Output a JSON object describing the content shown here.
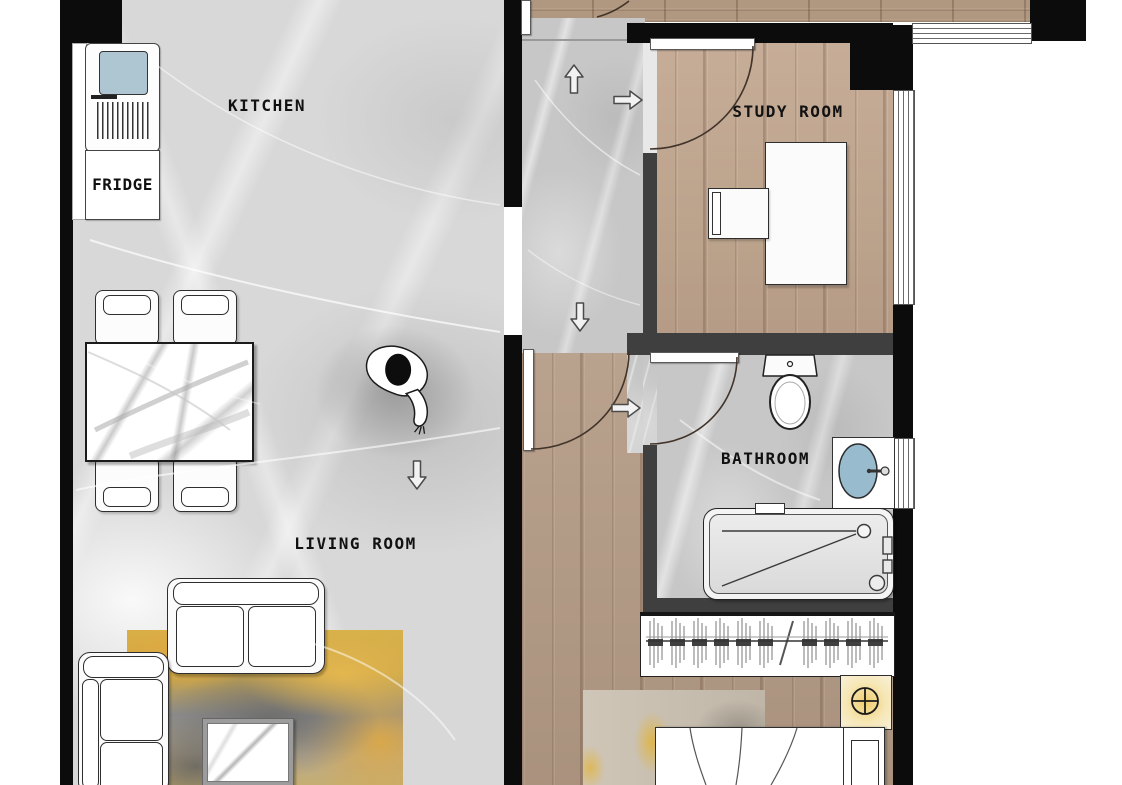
{
  "floor_plan": {
    "labels": {
      "kitchen": "KITCHEN",
      "fridge": "FRIDGE",
      "study_room": "STUDY ROOM",
      "bathroom": "BATHROOM",
      "living_room": "LIVING ROOM"
    },
    "rooms": [
      "kitchen",
      "living-room",
      "hallway",
      "study-room",
      "bathroom",
      "bedroom"
    ],
    "furniture": [
      "fridge",
      "kitchen-counter",
      "dining-table",
      "dining-chairs-x4",
      "corner-sofa",
      "two-seat-sofa",
      "coffee-table",
      "living-room-rug",
      "desk",
      "desk-chair",
      "toilet",
      "wash-basin",
      "bathtub",
      "wardrobe-with-hangers",
      "bed",
      "nightstand-with-lamp",
      "bedroom-rug"
    ],
    "symbols": {
      "person-top-view": "walking figure seen from above",
      "flow-arrow": "white direction arrow",
      "door-swing-arc": "quarter-circle door swing",
      "ceiling-lamp": "circle with crosshair",
      "window": "parallel lines in wall opening"
    },
    "colors": {
      "wall": "#0c0c0c",
      "partition_wall": "#3f3f3f",
      "marble_floor": "#d8d8d8",
      "hall_marble_floor": "#c7c7c7",
      "wood_floor": "#b49b85",
      "basin_blue": "#98bcce",
      "appliance_screen_blue": "#adc6d2",
      "lamp_glow_yellow": "#f0cc6f",
      "rug_yellow": "#dfa93f",
      "rug_gray": "#7e7e7e"
    }
  }
}
